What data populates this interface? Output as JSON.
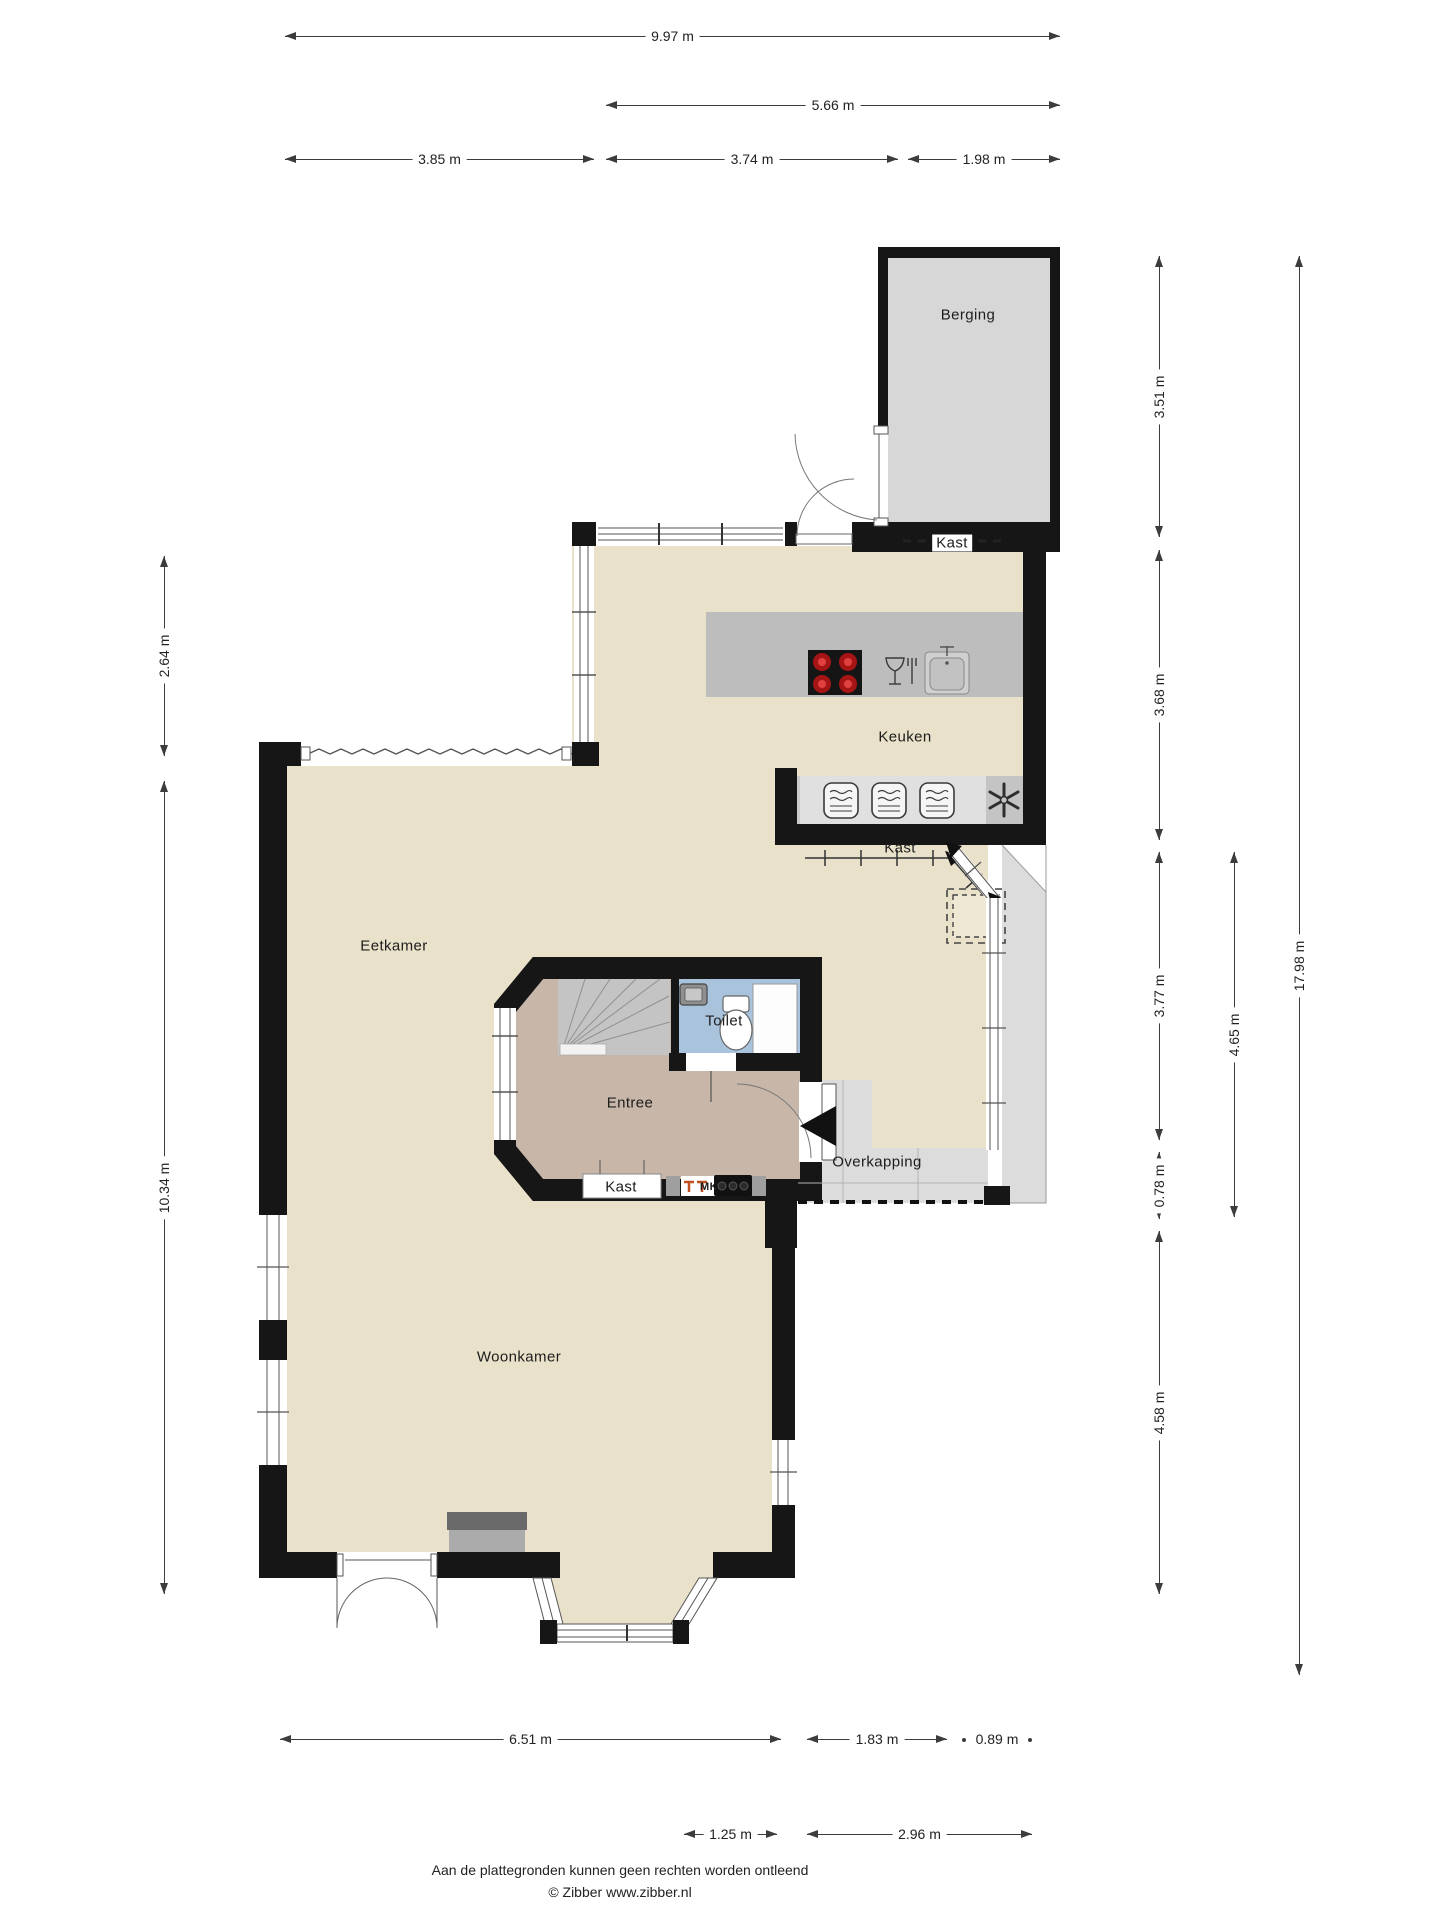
{
  "floorplan": {
    "rooms": [
      {
        "id": "berging",
        "label": "Berging",
        "x": 968,
        "y": 315
      },
      {
        "id": "keuken",
        "label": "Keuken",
        "x": 905,
        "y": 737
      },
      {
        "id": "kast-keuken",
        "label": "Kast",
        "x": 952,
        "y": 543,
        "bg": true
      },
      {
        "id": "kast-hal",
        "label": "Kast",
        "x": 900,
        "y": 848
      },
      {
        "id": "eetkamer",
        "label": "Eetkamer",
        "x": 394,
        "y": 946
      },
      {
        "id": "toilet",
        "label": "Toilet",
        "x": 724,
        "y": 1021
      },
      {
        "id": "entree",
        "label": "Entree",
        "x": 630,
        "y": 1103
      },
      {
        "id": "kast-entree",
        "label": "Kast",
        "x": 621,
        "y": 1187
      },
      {
        "id": "meterkast",
        "label": "MK",
        "x": 709,
        "y": 1187,
        "small": true
      },
      {
        "id": "overkapping",
        "label": "Overkapping",
        "x": 877,
        "y": 1162
      },
      {
        "id": "woonkamer",
        "label": "Woonkamer",
        "x": 519,
        "y": 1357
      }
    ],
    "dimensions": [
      {
        "label": "9.97 m",
        "orient": "h",
        "x1": 285,
        "x2": 1060,
        "y": 37
      },
      {
        "label": "5.66 m",
        "orient": "h",
        "x1": 606,
        "x2": 1060,
        "y": 106
      },
      {
        "label": "3.85 m",
        "orient": "h",
        "x1": 285,
        "x2": 594,
        "y": 160
      },
      {
        "label": "3.74 m",
        "orient": "h",
        "x1": 606,
        "x2": 898,
        "y": 160
      },
      {
        "label": "1.98 m",
        "orient": "h",
        "x1": 908,
        "x2": 1060,
        "y": 160
      },
      {
        "label": "2.64 m",
        "orient": "v",
        "y1": 556,
        "y2": 756,
        "x": 165
      },
      {
        "label": "10.34 m",
        "orient": "v",
        "y1": 781,
        "y2": 1594,
        "x": 165
      },
      {
        "label": "3.51 m",
        "orient": "v",
        "y1": 256,
        "y2": 537,
        "x": 1160
      },
      {
        "label": "3.68 m",
        "orient": "v",
        "y1": 550,
        "y2": 840,
        "x": 1160
      },
      {
        "label": "3.77 m",
        "orient": "v",
        "y1": 852,
        "y2": 1140,
        "x": 1160
      },
      {
        "label": "0.78 m",
        "orient": "v",
        "y1": 1152,
        "y2": 1219,
        "x": 1160
      },
      {
        "label": "4.58 m",
        "orient": "v",
        "y1": 1231,
        "y2": 1594,
        "x": 1160
      },
      {
        "label": "4.65 m",
        "orient": "v",
        "y1": 852,
        "y2": 1217,
        "x": 1235
      },
      {
        "label": "17.98 m",
        "orient": "v",
        "y1": 256,
        "y2": 1675,
        "x": 1300
      },
      {
        "label": "6.51 m",
        "orient": "h",
        "x1": 280,
        "x2": 781,
        "y": 1740
      },
      {
        "label": "1.83 m",
        "orient": "h",
        "x1": 807,
        "x2": 947,
        "y": 1740
      },
      {
        "label": "0.89 m",
        "orient": "h",
        "x1": 962,
        "x2": 1032,
        "y": 1740,
        "style": "dots"
      },
      {
        "label": "1.25 m",
        "orient": "h",
        "x1": 684,
        "x2": 777,
        "y": 1835
      },
      {
        "label": "2.96 m",
        "orient": "h",
        "x1": 807,
        "x2": 1032,
        "y": 1835
      }
    ],
    "colors": {
      "wall": "#161616",
      "floor_main": "#e9e1c9",
      "floor_entree": "#c8b7a9",
      "floor_toilet": "#a9c3dd",
      "floor_berging": "#d7d7d7",
      "floor_overkapping": "#dcdcdc",
      "counter": "#bdbdbd",
      "burner_red": "#c62828"
    },
    "footer": {
      "line1": "Aan de plattegronden kunnen geen rechten worden ontleend",
      "line2": "© Zibber www.zibber.nl"
    }
  }
}
